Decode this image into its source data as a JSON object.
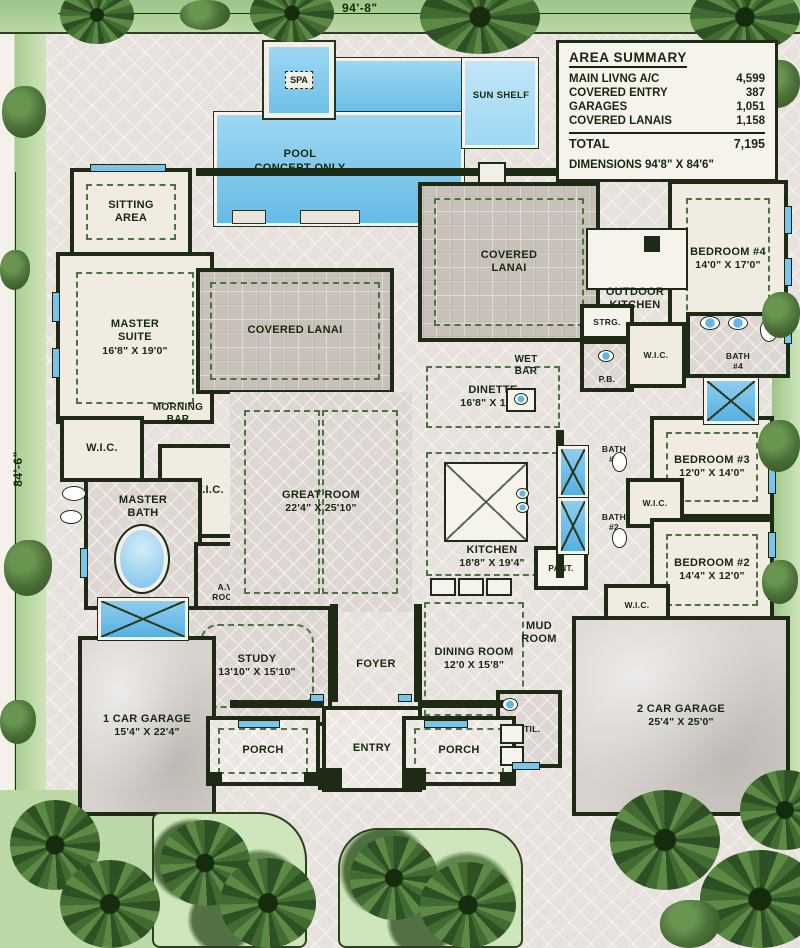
{
  "plan": {
    "top_dimension": "94'-8\"",
    "left_dimension": "84'-6\""
  },
  "area_summary": {
    "title": "AREA SUMMARY",
    "rows": [
      {
        "label": "MAIN LIVNG A/C",
        "value": "4,599"
      },
      {
        "label": "COVERED ENTRY",
        "value": "387"
      },
      {
        "label": "GARAGES",
        "value": "1,051"
      },
      {
        "label": "COVERED LANAIS",
        "value": "1,158"
      }
    ],
    "total": {
      "label": "TOTAL",
      "value": "7,195"
    },
    "dimensions_note": "DIMENSIONS 94'8\" X 84'6\""
  },
  "pool": {
    "label": "POOL\nCONCEPT ONLY",
    "spa_label": "SPA",
    "sun_shelf_label": "SUN SHELF"
  },
  "rooms": {
    "sitting_area": {
      "label": "SITTING\nAREA"
    },
    "master_suite": {
      "label": "MASTER\nSUITE",
      "dims": "16'8\" X 19'0\""
    },
    "covered_lanai_west": {
      "label": "COVERED LANAI"
    },
    "covered_lanai_central": {
      "label": "COVERED\nLANAI"
    },
    "outdoor_kitchen": {
      "label": "OUTDOOR\nKITCHEN"
    },
    "bedroom_4": {
      "label": "BEDROOM #4",
      "dims": "14'0\" X 17'0\""
    },
    "wic_master_1": {
      "label": "W.I.C."
    },
    "morning_bar": {
      "label": "MORNING\nBAR"
    },
    "wic_master_2": {
      "label": "W.I.C."
    },
    "master_bath": {
      "label": "MASTER\nBATH"
    },
    "av_room": {
      "label": "A.V.\nROOM"
    },
    "great_room": {
      "label": "GREAT ROOM",
      "dims": "22'4\" X 25'10\""
    },
    "dinette": {
      "label": "DINETTE",
      "dims": "16'8\" X 10'8\""
    },
    "wet_bar": {
      "label": "WET\nBAR"
    },
    "strg": {
      "label": "STRG."
    },
    "pb": {
      "label": "P.B."
    },
    "wic_bed4": {
      "label": "W.I.C."
    },
    "bath_4": {
      "label": "BATH\n#4"
    },
    "bath_3": {
      "label": "BATH\n#3"
    },
    "bedroom_3": {
      "label": "BEDROOM #3",
      "dims": "12'0\" X 14'0\""
    },
    "wic_bed3": {
      "label": "W.I.C."
    },
    "bath_2": {
      "label": "BATH\n#2"
    },
    "bedroom_2": {
      "label": "BEDROOM #2",
      "dims": "14'4\" X 12'0\""
    },
    "kitchen": {
      "label": "KITCHEN",
      "dims": "18'8\" X 19'4\""
    },
    "pantry": {
      "label": "PANT."
    },
    "wic_bed2": {
      "label": "W.I.C."
    },
    "mud_room": {
      "label": "MUD\nROOM"
    },
    "study": {
      "label": "STUDY",
      "dims": "13'10\" X 15'10\""
    },
    "foyer": {
      "label": "FOYER"
    },
    "dining_room": {
      "label": "DINING ROOM",
      "dims": "12'0 X 15'8\""
    },
    "utility": {
      "label": "UTIL."
    },
    "garage_1": {
      "label": "1 CAR GARAGE",
      "dims": "15'4\" X 22'4\""
    },
    "garage_2": {
      "label": "2 CAR GARAGE",
      "dims": "25'4\" X 25'0\""
    },
    "porch_west": {
      "label": "PORCH"
    },
    "entry": {
      "label": "ENTRY"
    },
    "porch_east": {
      "label": "PORCH"
    }
  },
  "colors": {
    "pool_blue": "#66bbe6",
    "wall_dark": "#1d2b15",
    "window_blue": "#79c4e8",
    "lawn_green": "#bcd8a6",
    "paver_gray": "#c7c1ba"
  }
}
